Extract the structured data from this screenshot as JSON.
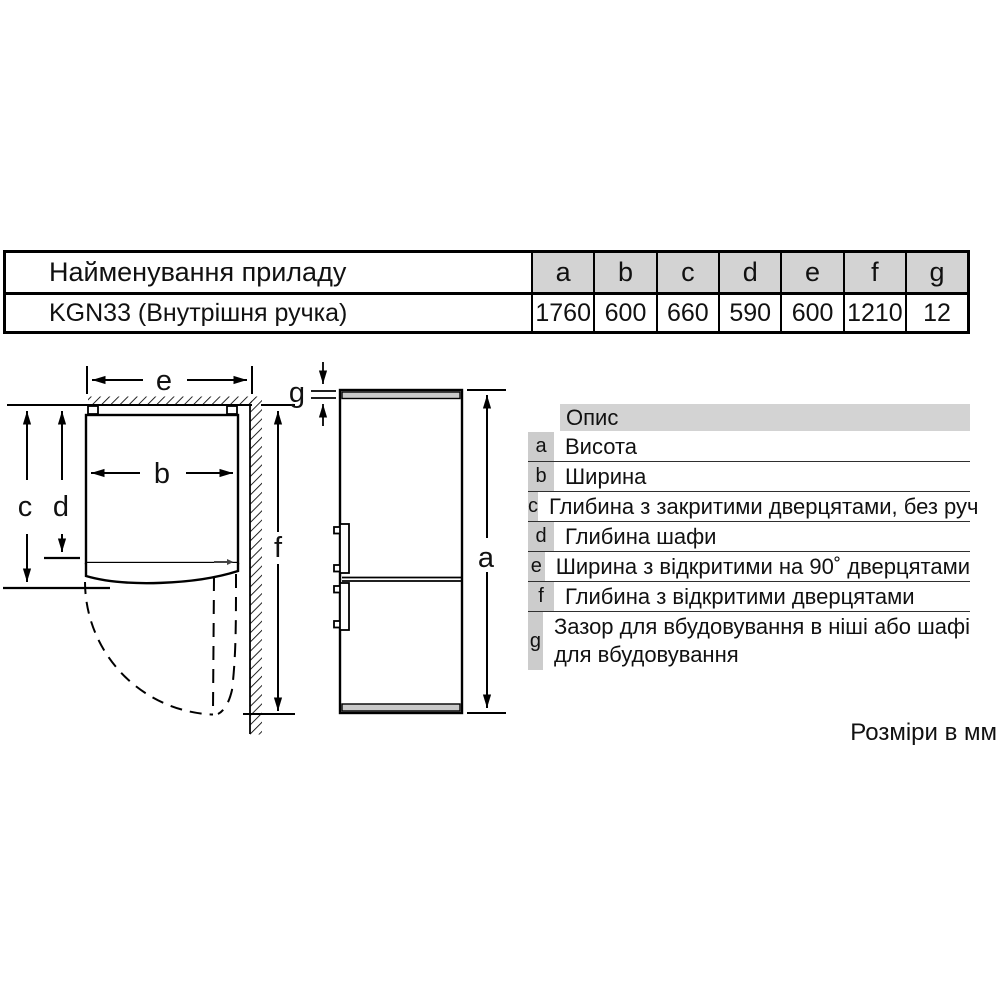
{
  "colors": {
    "header_bg": "#d3d3d3",
    "legend_letter_bg": "#cccccc",
    "strip_gray": "#c9c9c9",
    "line": "#000000"
  },
  "spec_table": {
    "name_header": "Найменування приладу",
    "model_row": "KGN33 (Внутрішня ручка)",
    "dim_headers": [
      "a",
      "b",
      "c",
      "d",
      "e",
      "f",
      "g"
    ],
    "dim_values": [
      "1760",
      "600",
      "660",
      "590",
      "600",
      "1210",
      "12"
    ]
  },
  "legend": {
    "header": "Опис",
    "rows": [
      {
        "key": "a",
        "desc": "Висота"
      },
      {
        "key": "b",
        "desc": "Ширина"
      },
      {
        "key": "c",
        "desc": "Глибина з закритими дверцятами, без руч"
      },
      {
        "key": "d",
        "desc": "Глибина шафи"
      },
      {
        "key": "e",
        "desc": "Ширина з відкритими на 90˚ дверцятами"
      },
      {
        "key": "f",
        "desc": "Глибина з відкритими дверцятами"
      },
      {
        "key": "g",
        "desc": "Зазор для вбудовування в ніші або шафі",
        "desc_line2": "для вбудовування"
      }
    ]
  },
  "diagram": {
    "labels": {
      "a": "a",
      "b": "b",
      "c": "c",
      "d": "d",
      "e": "e",
      "f": "f",
      "g": "g"
    }
  },
  "footer": {
    "units_note": "Розміри в мм"
  }
}
